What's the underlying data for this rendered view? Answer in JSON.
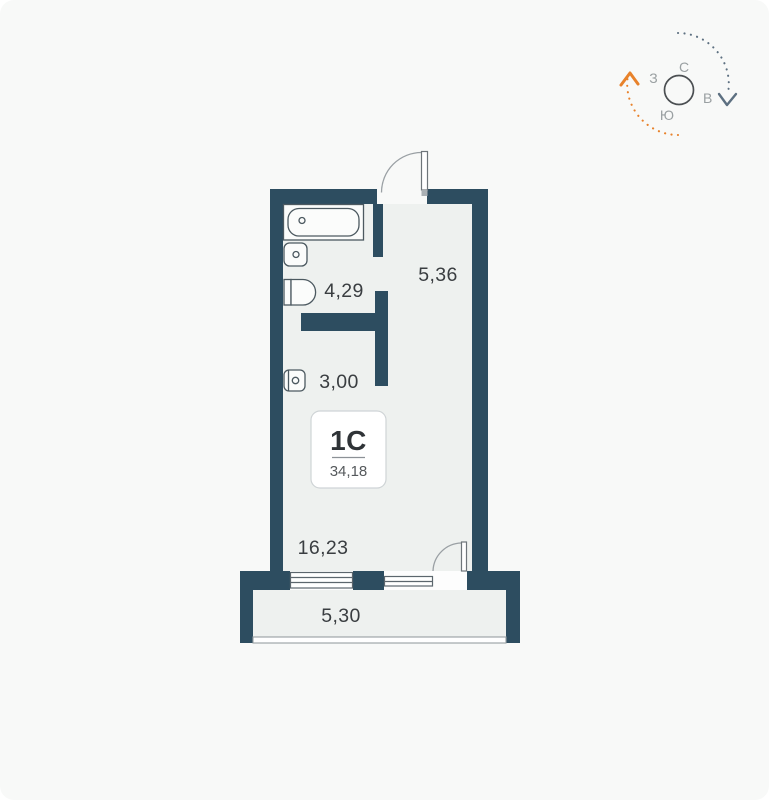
{
  "unit": {
    "type": "1С",
    "area": "34,18"
  },
  "rooms": [
    {
      "id": "bathroom",
      "label": "4,29"
    },
    {
      "id": "hallway",
      "label": "5,36"
    },
    {
      "id": "storage",
      "label": "3,00"
    },
    {
      "id": "living-room",
      "label": "16,23"
    },
    {
      "id": "balcony",
      "label": "5,30"
    }
  ],
  "compass": {
    "north": "С",
    "south": "Ю",
    "west": "З",
    "east": "В"
  },
  "colors": {
    "wall": "#2d4d60",
    "floor": "#eef1ef",
    "background": "#f8f9f8",
    "fixture_fill": "#fbfcfb",
    "outline": "#4c5960",
    "door_arc": "#9aa0a4",
    "accent_orange": "#e8822b",
    "accent_blue_gray": "#5d7081"
  }
}
